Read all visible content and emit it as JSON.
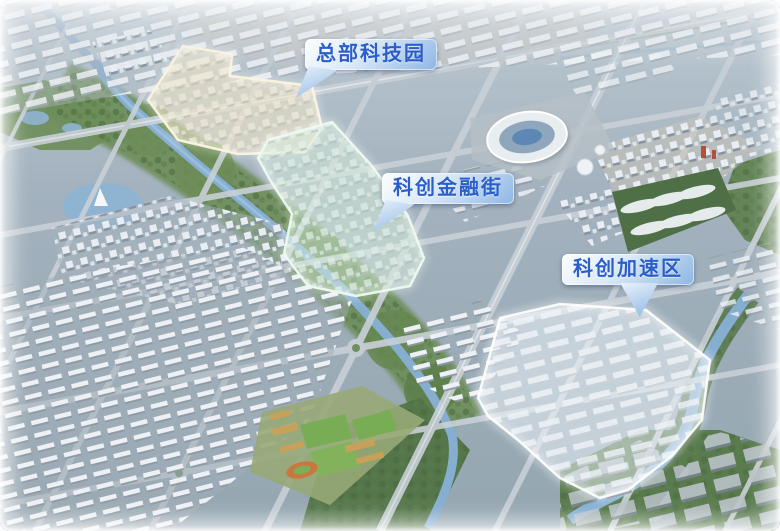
{
  "scene": {
    "description": "aerial-city-masterplan-render",
    "zones": [
      {
        "id": "headquarters-tech-park",
        "label": "总部科技园",
        "glow_color": "#f2e6c6"
      },
      {
        "id": "sci-tech-finance-street",
        "label": "科创金融街",
        "glow_color": "#d9efdb"
      },
      {
        "id": "sci-tech-acceleration-zone",
        "label": "科创加速区",
        "glow_color": "#eef4f9"
      }
    ],
    "callout_style": {
      "text_color": "#2b5ec9",
      "bg_gradient_start": "#fdfeff",
      "bg_gradient_end": "#8db6e4"
    },
    "landmark_icons": [
      "stadium-icon",
      "river-icon",
      "lake-icon",
      "green-corridor-icon",
      "sports-campus-icon",
      "residential-blocks-icon",
      "warehouse-district-icon"
    ]
  }
}
